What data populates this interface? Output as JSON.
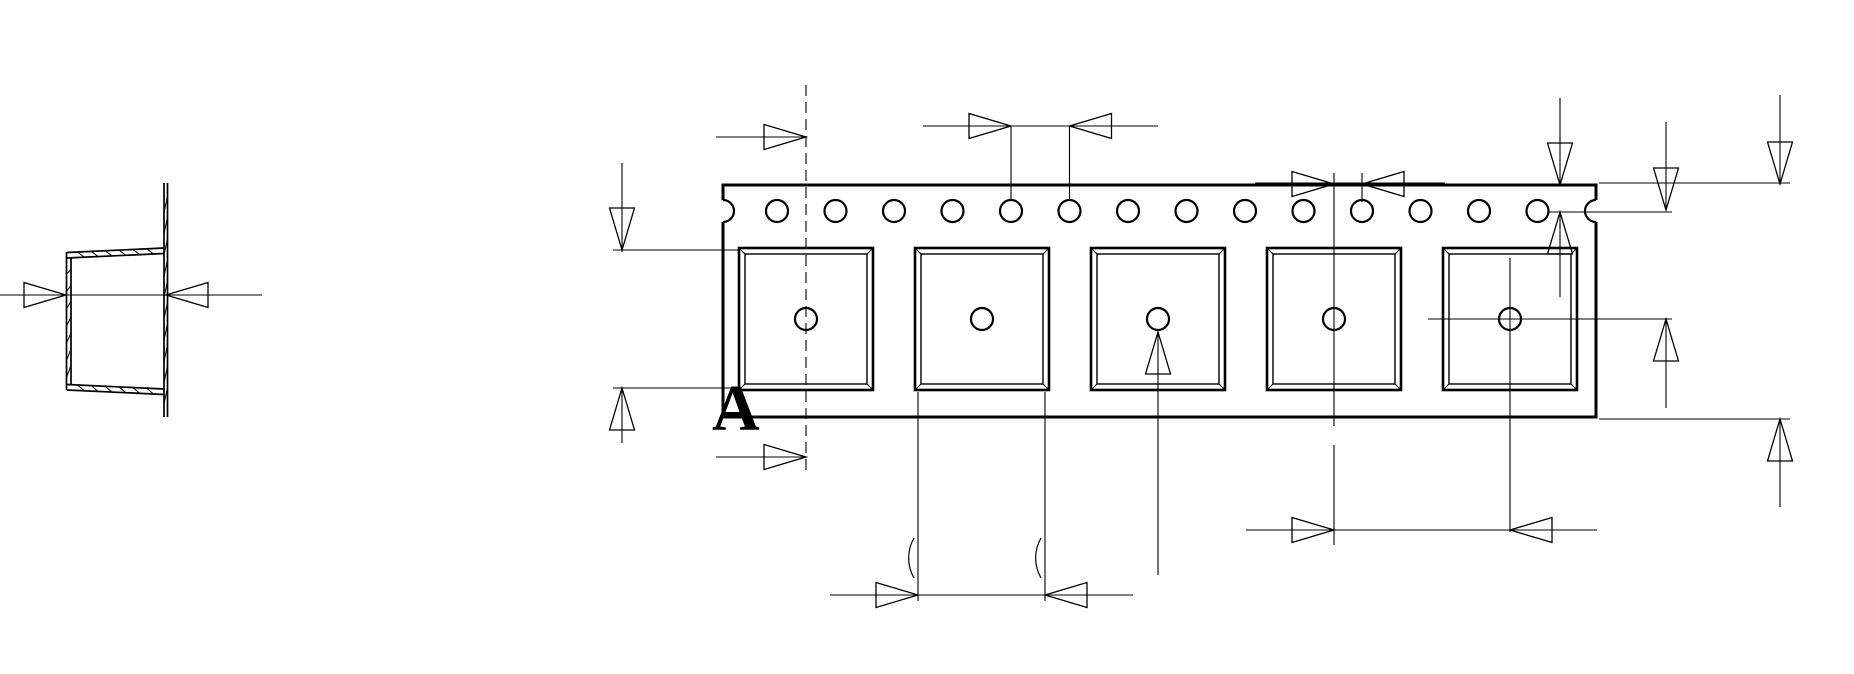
{
  "meta": {
    "background_color": "#ffffff",
    "ink_color": "#000000",
    "canvas_width": 1854,
    "canvas_height": 674,
    "drawing_type": "carrier-tape-dimension-drawing"
  },
  "section_label": {
    "text": "A",
    "x": 712,
    "y": 430,
    "font_size": 66
  },
  "cross_section": {
    "stroke": 1.7,
    "wall_pairs": [
      {
        "a": [
          164,
          183,
          164,
          417
        ],
        "b": [
          167.5,
          183,
          167.5,
          417
        ],
        "hatch": 10
      },
      {
        "a": [
          164,
          248,
          67,
          252.5
        ],
        "b": [
          164,
          253.5,
          67,
          258
        ],
        "hatch": 6
      },
      {
        "a": [
          66.5,
          252,
          66.5,
          390
        ],
        "b": [
          71,
          258,
          71,
          385.5
        ],
        "hatch": 7
      },
      {
        "a": [
          67,
          390,
          164,
          394.5
        ],
        "b": [
          67,
          384.5,
          164,
          389
        ],
        "hatch": 6
      }
    ]
  },
  "tape": {
    "x": 723,
    "y": 185,
    "w": 873,
    "h": 232,
    "stroke": 3
  },
  "edge_notches": [
    {
      "cx": 723,
      "cy": 211,
      "r": 11,
      "bulge": "right"
    },
    {
      "cx": 1596,
      "cy": 211,
      "r": 11,
      "bulge": "left"
    }
  ],
  "sprocket_holes": {
    "cy": 211,
    "r": 11,
    "stroke": 2.2,
    "xs": [
      777,
      835.5,
      894,
      952.5,
      1011,
      1069.5,
      1128,
      1186.5,
      1245,
      1303.5,
      1362,
      1420.5,
      1479,
      1537.5
    ]
  },
  "pockets": {
    "centers_x": [
      806,
      982,
      1158,
      1334,
      1510
    ],
    "half_w": 67,
    "top": 248,
    "bottom": 390,
    "inset": 6,
    "outer_stroke": 2.6,
    "inner_stroke": 1.4,
    "hole_cy": 319,
    "hole_r": 11,
    "hole_stroke": 2.2
  },
  "dashed_lines": [
    [
      806,
      85,
      806,
      470
    ]
  ],
  "dim_lines": [
    [
      0,
      295,
      262,
      295
    ],
    [
      716,
      137,
      806,
      137
    ],
    [
      716,
      457,
      806,
      457
    ],
    [
      622,
      163,
      622,
      252
    ],
    [
      622,
      388,
      622,
      443
    ],
    [
      613,
      250,
      740,
      250
    ],
    [
      613,
      388,
      740,
      388
    ],
    [
      923,
      126,
      1158,
      126
    ],
    [
      1011,
      126,
      1011,
      199
    ],
    [
      1069.5,
      126,
      1069.5,
      199
    ],
    [
      1255,
      183,
      1445,
      183
    ],
    [
      1334,
      173,
      1334,
      426
    ],
    [
      1334,
      445,
      1334,
      545
    ],
    [
      1362,
      173,
      1362,
      202
    ],
    [
      1560,
      98,
      1560,
      185
    ],
    [
      1560,
      212,
      1560,
      297
    ],
    [
      1549,
      212,
      1672,
      212
    ],
    [
      1666,
      122,
      1666,
      210
    ],
    [
      1666,
      319,
      1666,
      408
    ],
    [
      1428,
      319,
      1672,
      319
    ],
    [
      1780,
      95,
      1780,
      184
    ],
    [
      1780,
      419,
      1780,
      507
    ],
    [
      1599,
      183,
      1790,
      183
    ],
    [
      1599,
      419,
      1790,
      419
    ],
    [
      1510,
      258,
      1510,
      532
    ],
    [
      1246,
      530,
      1597,
      530
    ],
    [
      918,
      392,
      918,
      601
    ],
    [
      1045,
      392,
      1045,
      601
    ],
    [
      830,
      595,
      1133,
      595
    ],
    [
      1158,
      332,
      1158,
      575
    ]
  ],
  "arrows": [
    {
      "tip": [
        66,
        295
      ],
      "dir": "right"
    },
    {
      "tip": [
        166,
        295
      ],
      "dir": "left"
    },
    {
      "tip": [
        806,
        137
      ],
      "dir": "right"
    },
    {
      "tip": [
        806,
        457
      ],
      "dir": "right"
    },
    {
      "tip": [
        622,
        250
      ],
      "dir": "down"
    },
    {
      "tip": [
        622,
        388
      ],
      "dir": "up"
    },
    {
      "tip": [
        1011,
        126
      ],
      "dir": "right"
    },
    {
      "tip": [
        1069.5,
        126
      ],
      "dir": "left"
    },
    {
      "tip": [
        1334,
        184
      ],
      "dir": "right"
    },
    {
      "tip": [
        1362,
        184
      ],
      "dir": "left"
    },
    {
      "tip": [
        1560,
        185
      ],
      "dir": "down"
    },
    {
      "tip": [
        1560,
        212
      ],
      "dir": "up"
    },
    {
      "tip": [
        1666,
        210
      ],
      "dir": "down"
    },
    {
      "tip": [
        1666,
        319
      ],
      "dir": "up"
    },
    {
      "tip": [
        1780,
        184
      ],
      "dir": "down"
    },
    {
      "tip": [
        1780,
        419
      ],
      "dir": "up"
    },
    {
      "tip": [
        1334,
        530
      ],
      "dir": "right"
    },
    {
      "tip": [
        1510,
        530
      ],
      "dir": "left"
    },
    {
      "tip": [
        918,
        595
      ],
      "dir": "right"
    },
    {
      "tip": [
        1045,
        595
      ],
      "dir": "left"
    },
    {
      "tip": [
        1158,
        332
      ],
      "dir": "up"
    }
  ],
  "arrow_style": {
    "length": 42,
    "half_width": 12.5,
    "stroke": 1.3
  },
  "dim_stroke": 1.1,
  "erased_fragments": [
    {
      "x": 914,
      "y1": 538,
      "y2": 578,
      "r": 40
    },
    {
      "x": 1041,
      "y1": 538,
      "y2": 578,
      "r": 40
    }
  ]
}
